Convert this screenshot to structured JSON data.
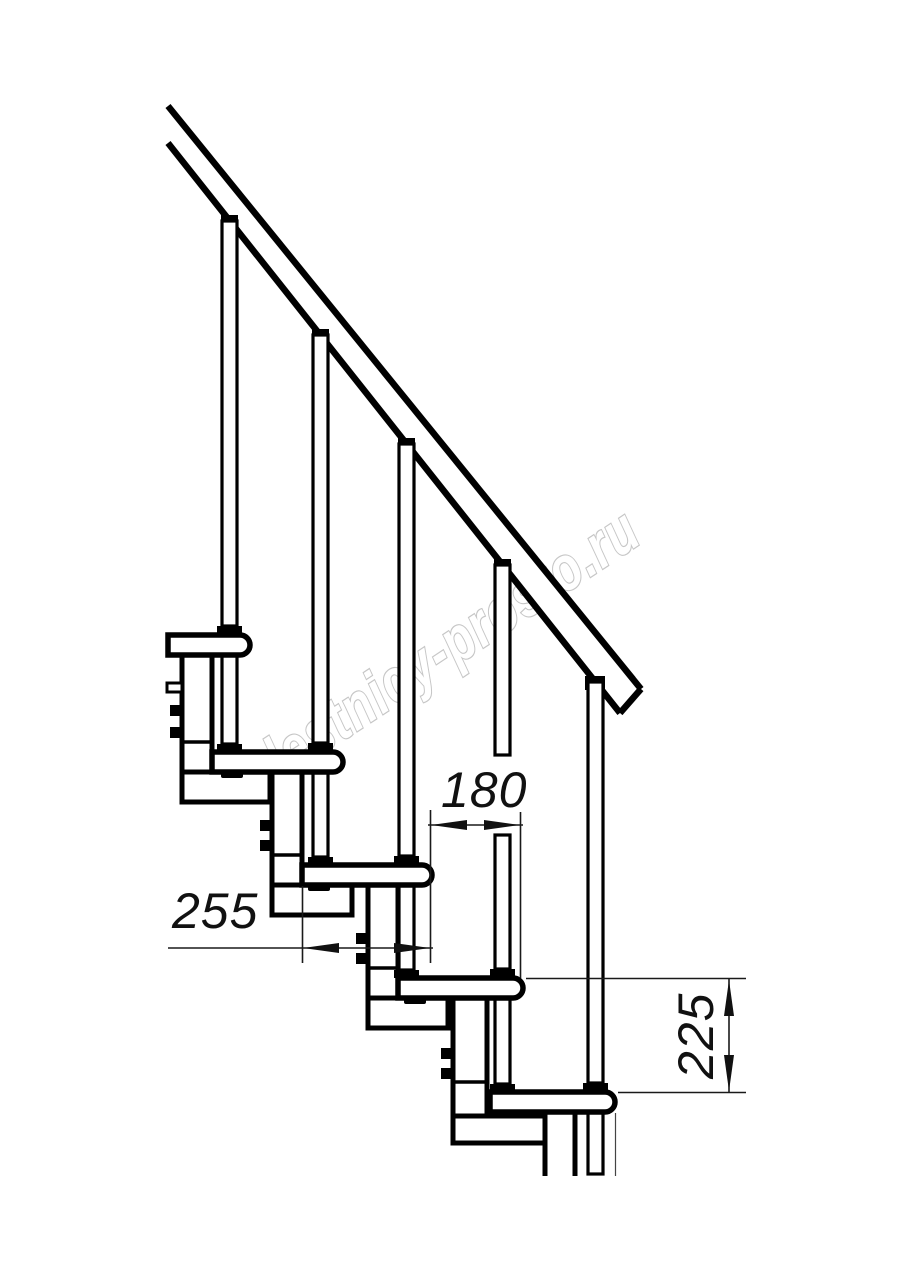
{
  "drawing": {
    "watermark": "lestnicy-prosto.ru",
    "dimensions": {
      "tread_depth": "255",
      "going": "180",
      "rise": "225"
    }
  }
}
